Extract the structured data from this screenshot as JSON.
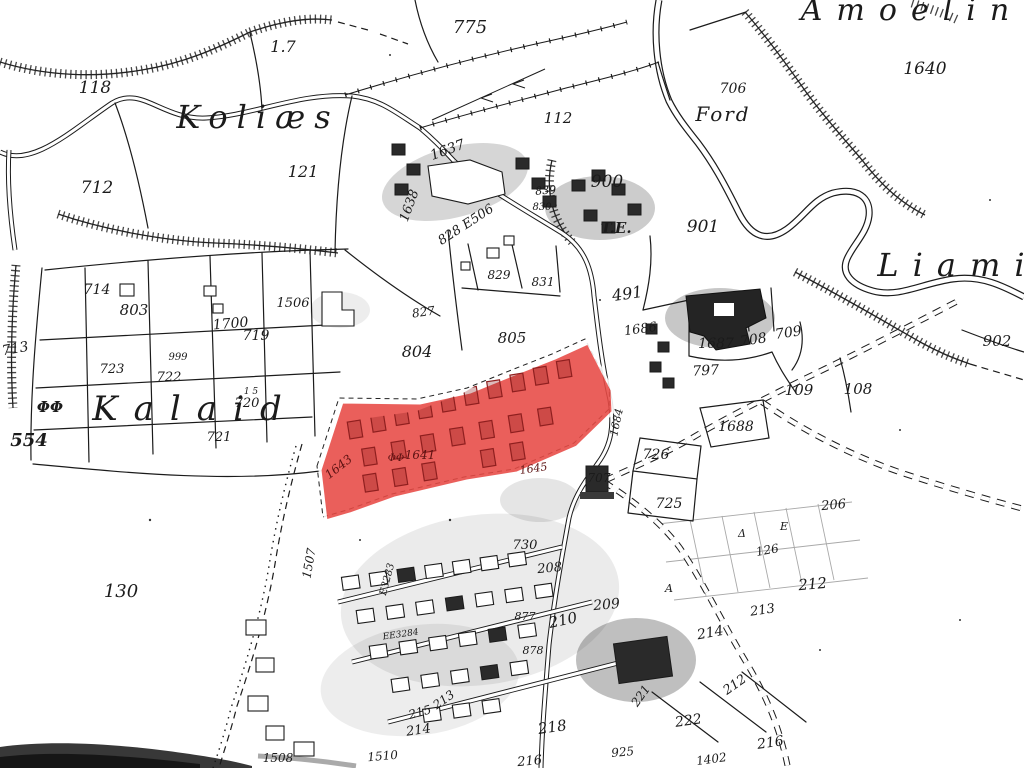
{
  "map": {
    "title": "Scanned cadastral survey map with highlighted village parcels",
    "highlight": {
      "name": "selected-parcel-area",
      "fill": "#e84a45",
      "inner_building_color": "#8f1f1f"
    },
    "colors": {
      "paper": "#ffffff",
      "ink": "#1b1b1b",
      "faded_lines": "#a9a9a9",
      "scan_band": "#151515"
    },
    "labels": [
      {
        "t": "Amoelin",
        "x": 912,
        "y": 20,
        "s": 30,
        "ls": 14
      },
      {
        "t": "Koliæs",
        "x": 258,
        "y": 128,
        "s": 32,
        "ls": 9
      },
      {
        "t": "Liami",
        "x": 958,
        "y": 276,
        "s": 32,
        "ls": 14
      },
      {
        "t": "Kalaid",
        "x": 195,
        "y": 420,
        "s": 34,
        "ls": 16
      },
      {
        "t": "Ford",
        "x": 723,
        "y": 121,
        "s": 20,
        "ls": 2
      },
      {
        "t": "T.E.",
        "x": 616,
        "y": 233,
        "s": 15,
        "c": "bold"
      },
      {
        "t": "118",
        "x": 95,
        "y": 93,
        "s": 17
      },
      {
        "t": "1.7",
        "x": 283,
        "y": 52,
        "s": 16
      },
      {
        "t": "775",
        "x": 470,
        "y": 33,
        "s": 18
      },
      {
        "t": "706",
        "x": 733,
        "y": 93,
        "s": 14
      },
      {
        "t": "1640",
        "x": 925,
        "y": 74,
        "s": 17
      },
      {
        "t": "712",
        "x": 97,
        "y": 193,
        "s": 17
      },
      {
        "t": "121",
        "x": 303,
        "y": 177,
        "s": 16
      },
      {
        "t": "112",
        "x": 558,
        "y": 123,
        "s": 15
      },
      {
        "t": "900",
        "x": 607,
        "y": 187,
        "s": 17
      },
      {
        "t": "901",
        "x": 703,
        "y": 232,
        "s": 17
      },
      {
        "t": "902",
        "x": 997,
        "y": 346,
        "s": 15
      },
      {
        "t": "108",
        "x": 858,
        "y": 394,
        "s": 15
      },
      {
        "t": "109",
        "x": 799,
        "y": 395,
        "s": 15
      },
      {
        "t": "713",
        "x": 16,
        "y": 353,
        "s": 14,
        "r": -10
      },
      {
        "t": "714",
        "x": 97,
        "y": 294,
        "s": 14
      },
      {
        "t": "803",
        "x": 134,
        "y": 315,
        "s": 15
      },
      {
        "t": "1700",
        "x": 231,
        "y": 328,
        "s": 14,
        "r": -5
      },
      {
        "t": "1506",
        "x": 293,
        "y": 307,
        "s": 13
      },
      {
        "t": "719",
        "x": 256,
        "y": 340,
        "s": 14
      },
      {
        "t": "827",
        "x": 424,
        "y": 316,
        "s": 12,
        "r": -8
      },
      {
        "t": "829",
        "x": 499,
        "y": 279,
        "s": 12
      },
      {
        "t": "831",
        "x": 543,
        "y": 286,
        "s": 12
      },
      {
        "t": "828 E506",
        "x": 468,
        "y": 228,
        "s": 13,
        "r": -33
      },
      {
        "t": "1637",
        "x": 449,
        "y": 154,
        "s": 14,
        "r": -20
      },
      {
        "t": "1638",
        "x": 413,
        "y": 207,
        "s": 13,
        "r": -70
      },
      {
        "t": "839",
        "x": 546,
        "y": 194,
        "s": 11,
        "r": -5
      },
      {
        "t": "830",
        "x": 542,
        "y": 210,
        "s": 10
      },
      {
        "t": "804",
        "x": 417,
        "y": 357,
        "s": 16
      },
      {
        "t": "805",
        "x": 512,
        "y": 343,
        "s": 15
      },
      {
        "t": "491",
        "x": 628,
        "y": 299,
        "s": 16,
        "r": -8
      },
      {
        "t": "1686",
        "x": 641,
        "y": 333,
        "s": 13,
        "r": -8
      },
      {
        "t": "1687",
        "x": 716,
        "y": 348,
        "s": 14
      },
      {
        "t": "708",
        "x": 754,
        "y": 344,
        "s": 14,
        "r": -8
      },
      {
        "t": "709",
        "x": 789,
        "y": 337,
        "s": 14,
        "r": -8
      },
      {
        "t": "797",
        "x": 706,
        "y": 375,
        "s": 14,
        "r": -3
      },
      {
        "t": "723",
        "x": 112,
        "y": 373,
        "s": 13
      },
      {
        "t": "999",
        "x": 178,
        "y": 360,
        "s": 10
      },
      {
        "t": "722",
        "x": 169,
        "y": 381,
        "s": 13
      },
      {
        "t": "720",
        "x": 247,
        "y": 407,
        "s": 13
      },
      {
        "t": "1 5",
        "x": 251,
        "y": 394,
        "s": 9
      },
      {
        "t": "721",
        "x": 219,
        "y": 441,
        "s": 13
      },
      {
        "t": "554",
        "x": 29,
        "y": 446,
        "s": 18,
        "c": "bold"
      },
      {
        "t": "130",
        "x": 121,
        "y": 597,
        "s": 18
      },
      {
        "t": "ΦΦ",
        "x": 50,
        "y": 412,
        "s": 15,
        "c": "bold"
      },
      {
        "t": "1643",
        "x": 341,
        "y": 470,
        "s": 12,
        "r": -38,
        "c": "red"
      },
      {
        "t": "1641",
        "x": 420,
        "y": 459,
        "s": 12,
        "c": "red"
      },
      {
        "t": "ΦΦ",
        "x": 396,
        "y": 461,
        "s": 10,
        "c": "red"
      },
      {
        "t": "1645",
        "x": 534,
        "y": 472,
        "s": 11,
        "r": -8,
        "c": "red"
      },
      {
        "t": "1684",
        "x": 620,
        "y": 423,
        "s": 11,
        "r": -78
      },
      {
        "t": "707",
        "x": 599,
        "y": 482,
        "s": 12
      },
      {
        "t": "726",
        "x": 656,
        "y": 459,
        "s": 14
      },
      {
        "t": "725",
        "x": 669,
        "y": 508,
        "s": 14
      },
      {
        "t": "1688",
        "x": 736,
        "y": 431,
        "s": 14
      },
      {
        "t": "206",
        "x": 834,
        "y": 509,
        "s": 13,
        "r": -5
      },
      {
        "t": "126",
        "x": 768,
        "y": 554,
        "s": 12,
        "r": -10
      },
      {
        "t": "Δ",
        "x": 742,
        "y": 537,
        "s": 11
      },
      {
        "t": "E",
        "x": 784,
        "y": 530,
        "s": 11
      },
      {
        "t": "A",
        "x": 669,
        "y": 592,
        "s": 11
      },
      {
        "t": "212",
        "x": 813,
        "y": 589,
        "s": 15,
        "r": -5
      },
      {
        "t": "213",
        "x": 763,
        "y": 614,
        "s": 13,
        "r": -8
      },
      {
        "t": "214",
        "x": 711,
        "y": 637,
        "s": 14,
        "r": -10
      },
      {
        "t": "212",
        "x": 737,
        "y": 688,
        "s": 13,
        "r": -35
      },
      {
        "t": "216",
        "x": 771,
        "y": 747,
        "s": 14,
        "r": -8
      },
      {
        "t": "218",
        "x": 553,
        "y": 732,
        "s": 15,
        "r": -8
      },
      {
        "t": "216",
        "x": 530,
        "y": 765,
        "s": 13,
        "r": -5
      },
      {
        "t": "222",
        "x": 689,
        "y": 725,
        "s": 14,
        "r": -8
      },
      {
        "t": "221",
        "x": 644,
        "y": 698,
        "s": 12,
        "r": -55
      },
      {
        "t": "925",
        "x": 623,
        "y": 756,
        "s": 12,
        "r": -5
      },
      {
        "t": "1402",
        "x": 712,
        "y": 763,
        "s": 12,
        "r": -8
      },
      {
        "t": "213",
        "x": 446,
        "y": 703,
        "s": 12,
        "r": -35
      },
      {
        "t": "215",
        "x": 421,
        "y": 716,
        "s": 12,
        "r": -15
      },
      {
        "t": "214",
        "x": 419,
        "y": 734,
        "s": 13,
        "r": -8
      },
      {
        "t": "730",
        "x": 525,
        "y": 549,
        "s": 13
      },
      {
        "t": "208",
        "x": 550,
        "y": 572,
        "s": 13,
        "r": -5
      },
      {
        "t": "209",
        "x": 607,
        "y": 609,
        "s": 14,
        "r": -5
      },
      {
        "t": "210",
        "x": 564,
        "y": 625,
        "s": 15,
        "r": -12
      },
      {
        "t": "877",
        "x": 525,
        "y": 620,
        "s": 11
      },
      {
        "t": "878",
        "x": 533,
        "y": 654,
        "s": 11
      },
      {
        "t": "1507",
        "x": 313,
        "y": 564,
        "s": 12,
        "r": -80
      },
      {
        "t": "E3283",
        "x": 390,
        "y": 580,
        "s": 10,
        "r": -75
      },
      {
        "t": "EE3284",
        "x": 401,
        "y": 637,
        "s": 9,
        "r": -8
      },
      {
        "t": "1508",
        "x": 278,
        "y": 762,
        "s": 12
      },
      {
        "t": "1510",
        "x": 383,
        "y": 760,
        "s": 12,
        "r": -5
      }
    ]
  }
}
